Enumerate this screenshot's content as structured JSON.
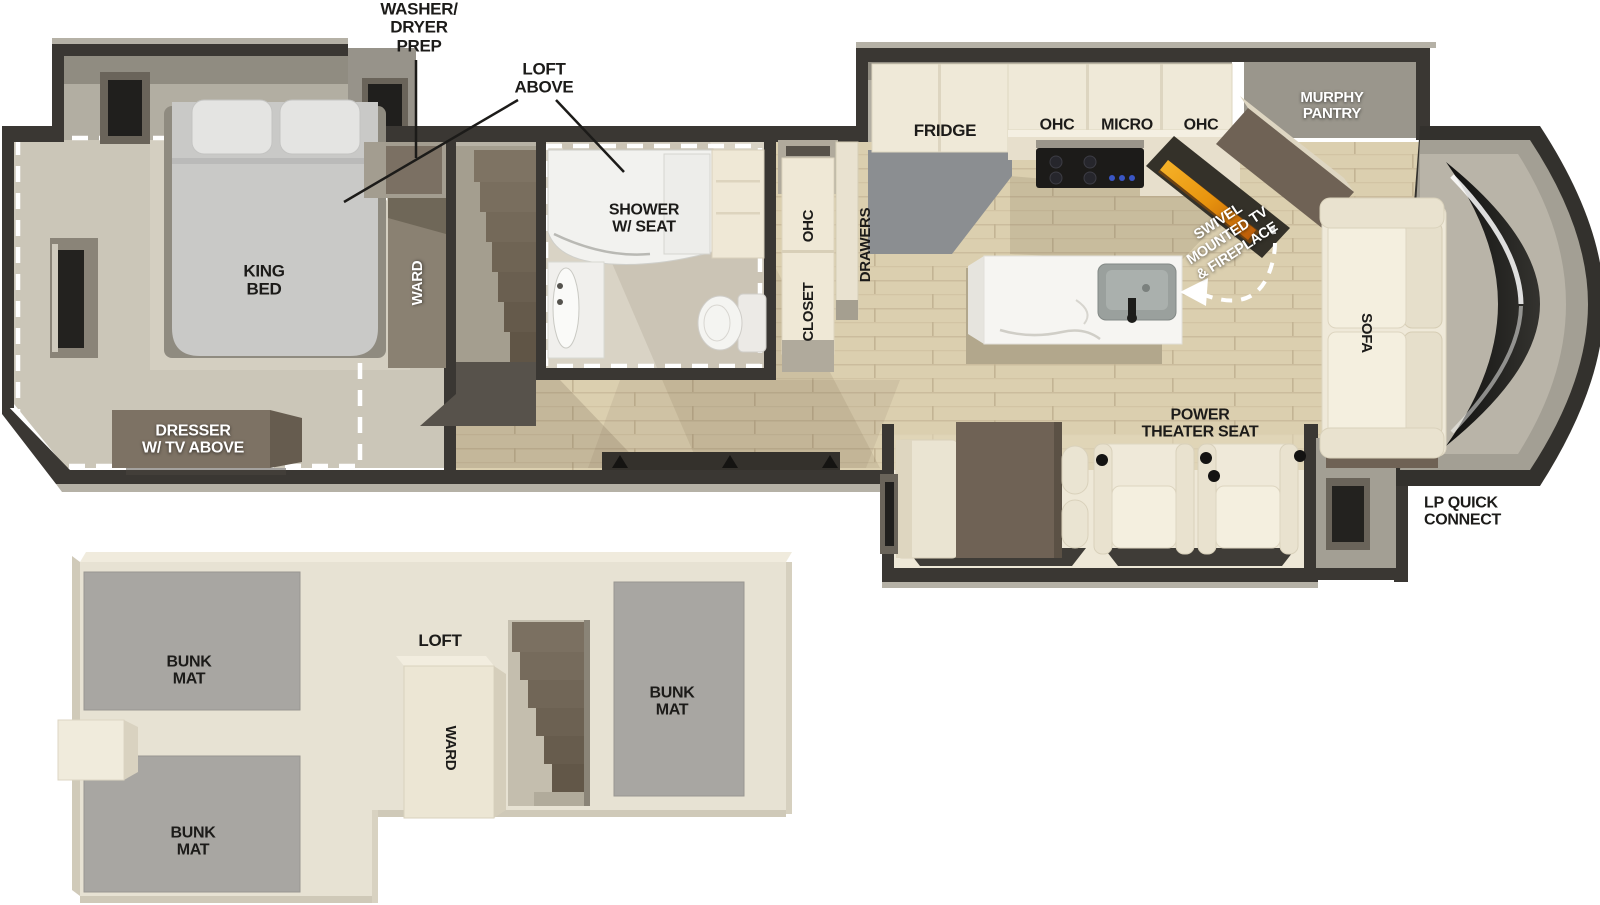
{
  "main_floor": {
    "callouts": {
      "washer_dryer_prep": "WASHER/\nDRYER\nPREP",
      "loft_above": "LOFT\nABOVE",
      "lp_quick_connect": "LP QUICK\nCONNECT"
    },
    "bedroom": {
      "king_bed": "KING\nBED",
      "ward": "WARD",
      "dresser": "DRESSER\nW/ TV ABOVE"
    },
    "bathroom": {
      "shower": "SHOWER\nW/ SEAT",
      "ohc": "OHC",
      "closet": "CLOSET"
    },
    "kitchen": {
      "drawers": "DRAWERS",
      "fridge": "FRIDGE",
      "ohc_left": "OHC",
      "micro": "MICRO",
      "ohc_right": "OHC"
    },
    "living_area": {
      "murphy_pantry": "MURPHY\nPANTRY",
      "swivel_tv_fireplace": "SWIVEL\nMOUNTED TV\n& FIREPLACE",
      "sofa": "SOFA",
      "power_theater_seat": "POWER\nTHEATER SEAT"
    }
  },
  "loft_floor": {
    "loft": "LOFT",
    "ward": "WARD",
    "bunk_mat_front": "BUNK\nMAT",
    "bunk_mat_rear": "BUNK\nMAT",
    "bunk_mat_side": "BUNK\nMAT"
  },
  "colors": {
    "wall": "#3a3733",
    "flame_accent": "#e8940e",
    "label_dark": "#1c1b19",
    "label_light": "#ffffff"
  }
}
